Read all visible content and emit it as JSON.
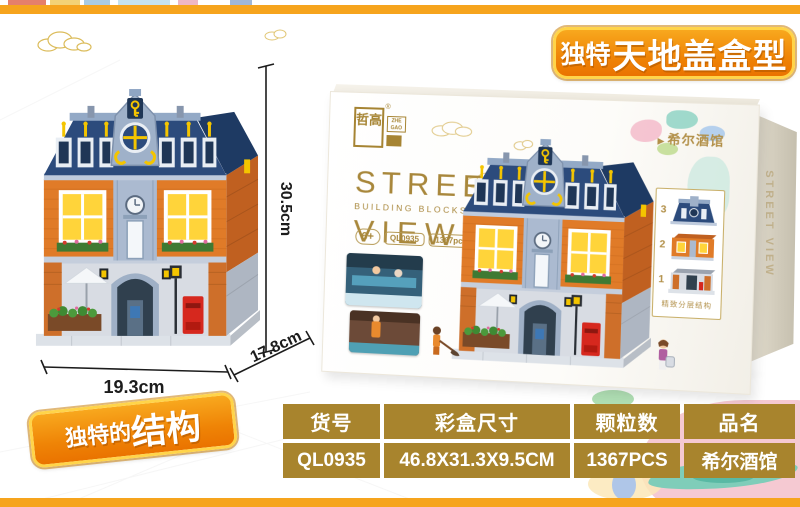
{
  "page": {
    "background": "#FFFFFF",
    "edge_bar_color": "#F6A41D"
  },
  "top_banner": {
    "prefix": "独特",
    "title": "天地盖盒型"
  },
  "structure_banner": {
    "prefix": "独特的",
    "title": "结构"
  },
  "model_dimensions": {
    "height": "30.5cm",
    "width": "19.3cm",
    "depth": "17.8cm"
  },
  "box": {
    "brand": {
      "cn": "哲高",
      "en": "ZHE GAO",
      "reg": "®"
    },
    "series": {
      "line1": "STREET",
      "line2": "BUILDING BLOCKS SERIES",
      "line3": "VIEW",
      "number": "1"
    },
    "badges": {
      "age": "6+",
      "model": "QL0935",
      "pieces": "1367pcs"
    },
    "product_name": "希尔酒馆",
    "product_name_arrow": "▶",
    "layer_panel": {
      "labels": [
        "3",
        "2",
        "1"
      ],
      "caption": "精致分层结构"
    },
    "side_text": "STREET VIEW"
  },
  "spec_table": {
    "headers": [
      "货号",
      "彩盒尺寸",
      "颗粒数",
      "品名"
    ],
    "values": [
      "QL0935",
      "46.8X31.3X9.5CM",
      "1367PCS",
      "希尔酒馆"
    ],
    "cell_color": "#A8842D",
    "text_color": "#FFFFFF"
  },
  "palette": {
    "accent_orange": "#F6A41D",
    "banner_gradient_top": "#F8A81E",
    "banner_gradient_bottom": "#EA7300",
    "banner_border": "#FFD44A",
    "table_gold": "#A8842D",
    "box_gold_text": "#A8873B",
    "roof_navy": "#2C4B7C",
    "brick_orange": "#E07B28",
    "mailbox_red": "#D6281E",
    "splash_pink": "#F5C9D2",
    "splash_teal": "#7FCDB9"
  }
}
